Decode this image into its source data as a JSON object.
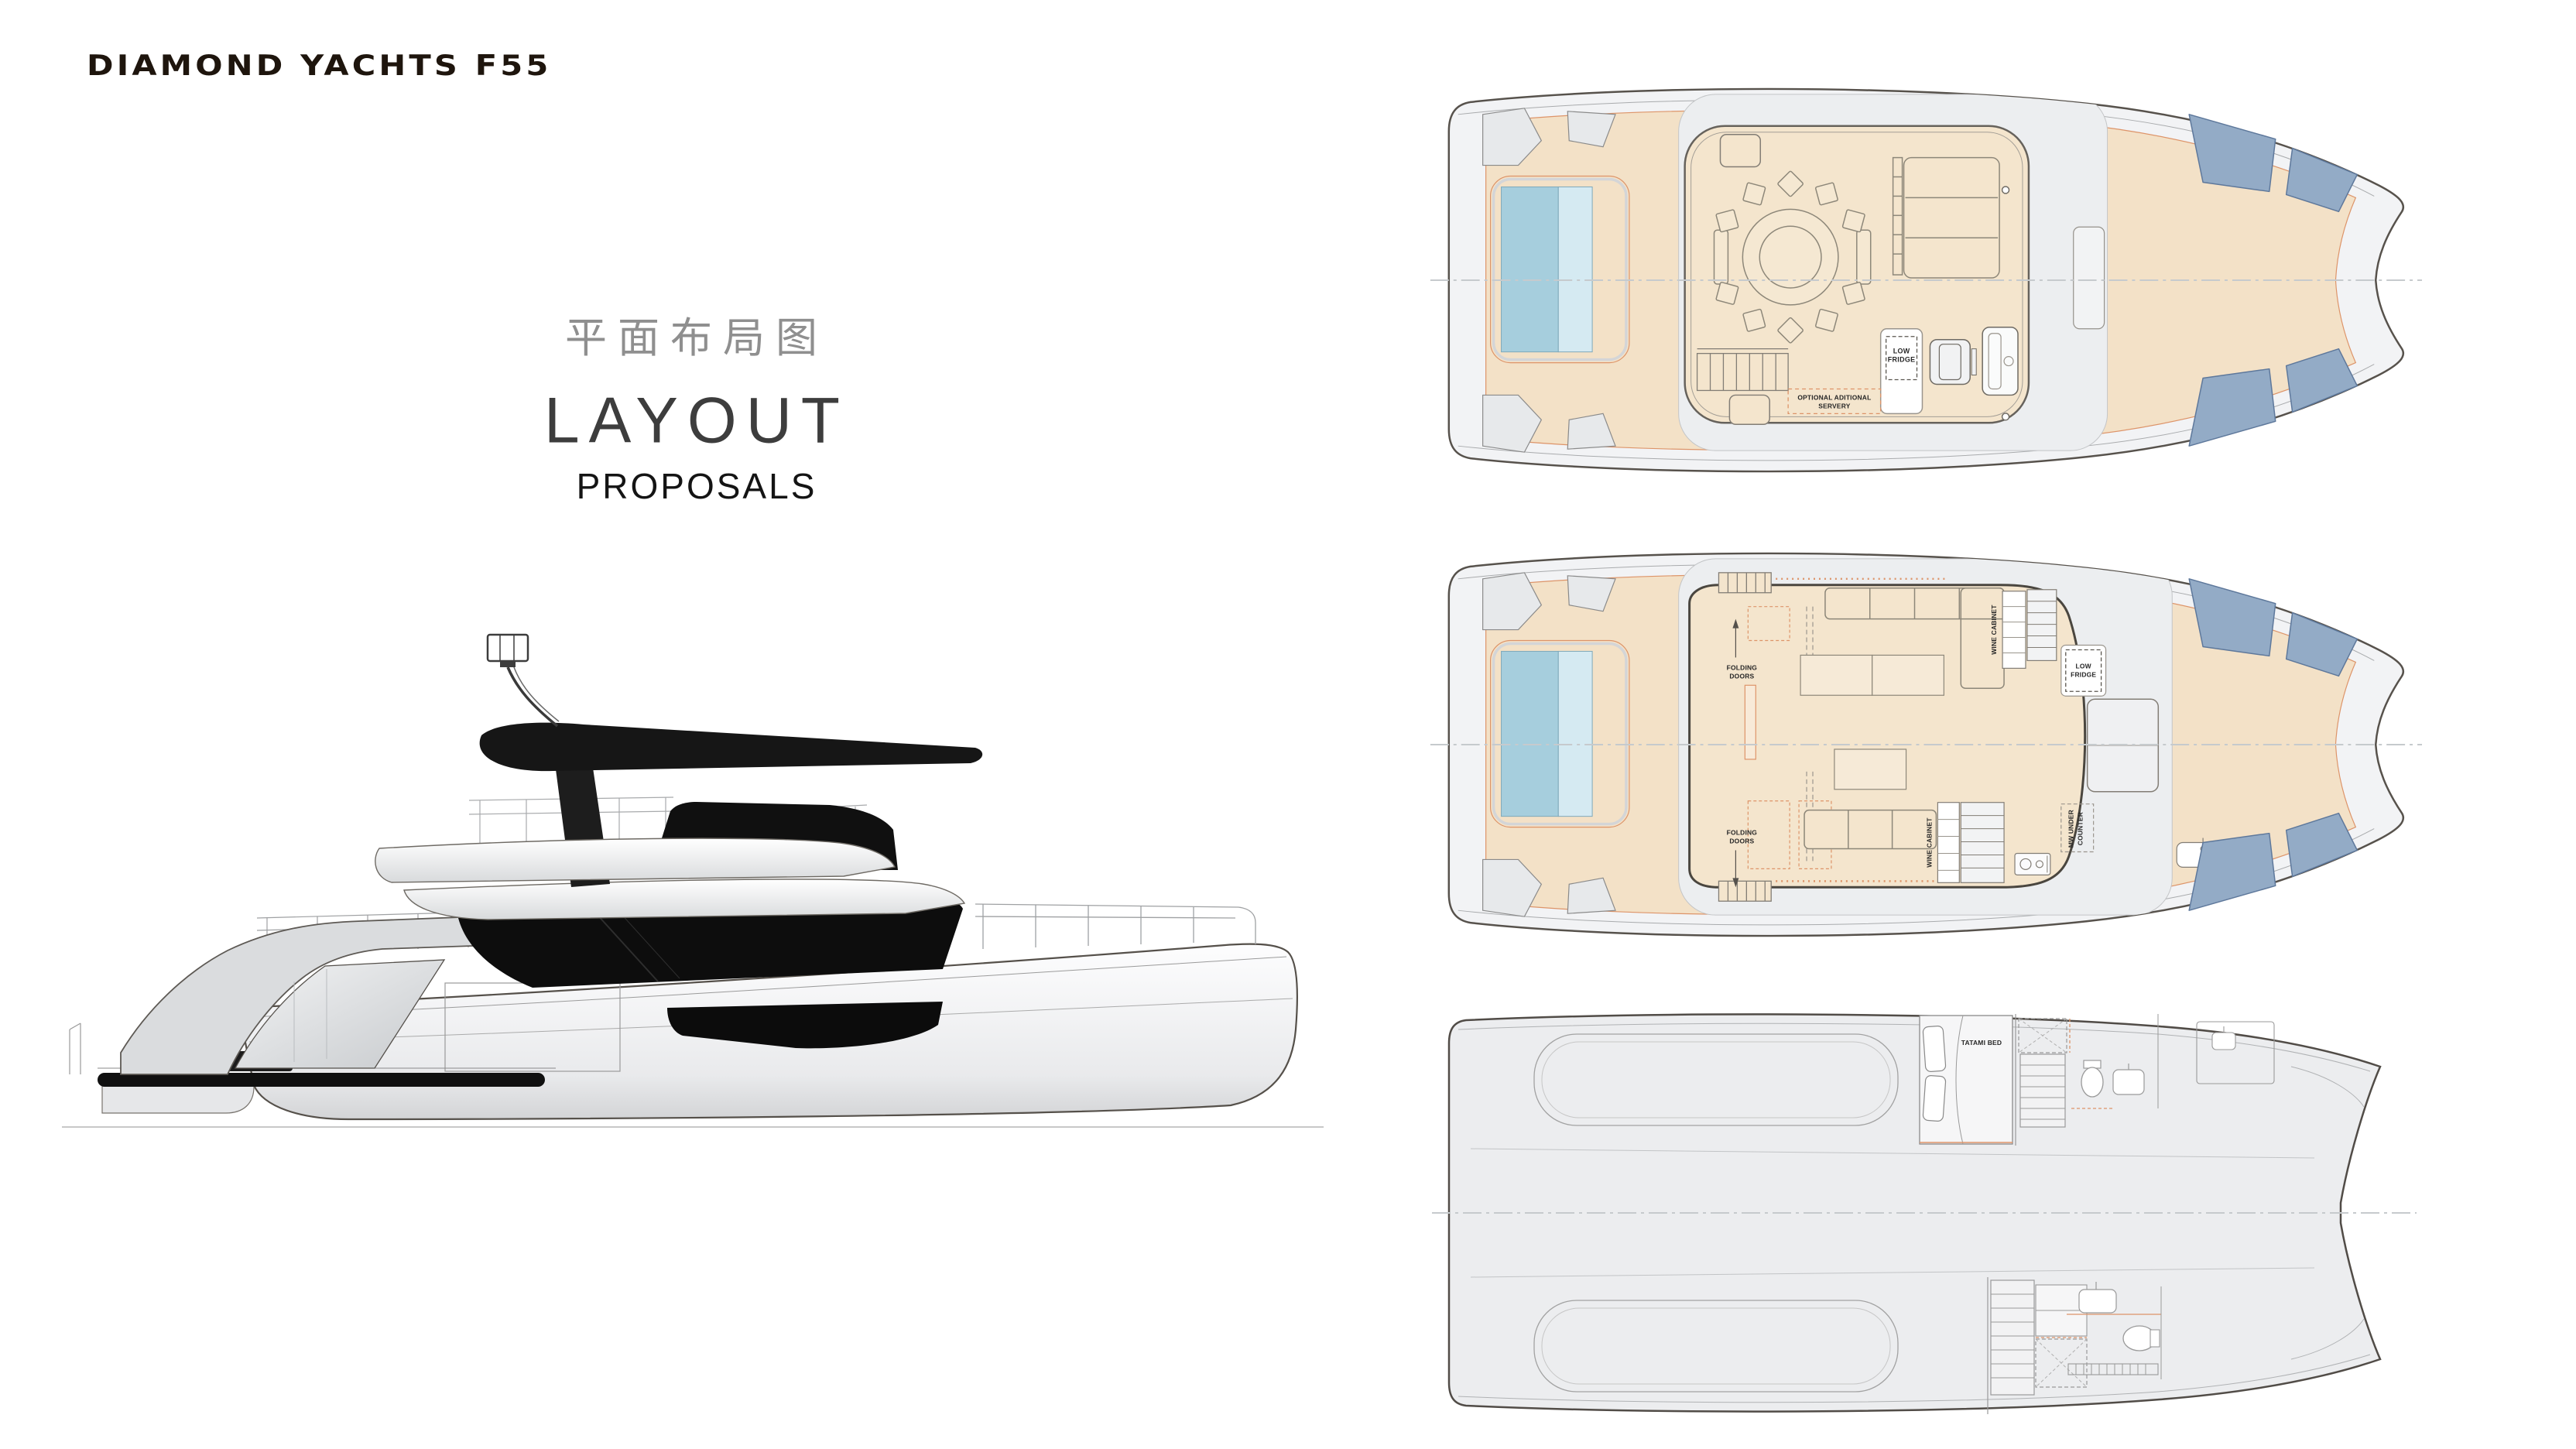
{
  "header": {
    "logo": "DIAMOND YACHTS F55"
  },
  "title": {
    "chinese": "平面布局图",
    "english": "LAYOUT",
    "subtitle": "PROPOSALS"
  },
  "colors": {
    "deck_beige": "#f3e1c7",
    "enclosure_beige": "#f4e5cd",
    "sunpad_blue": "#93abc6",
    "pool_blue_dark": "#a6cedd",
    "pool_blue_light": "#d5eaf2",
    "hull_gray": "#f2f3f5",
    "lower_deck_gray": "#ecedef",
    "accent_orange": "#dd9469",
    "glass_black": "#101010"
  },
  "decks": {
    "flybridge": {
      "labels": {
        "low_fridge": [
          "LOW",
          "FRIDGE"
        ],
        "servery": [
          "OPTIONAL ADITIONAL",
          "SERVERY"
        ]
      }
    },
    "main": {
      "labels": {
        "folding_doors": [
          "FOLDING",
          "DOORS"
        ],
        "wine_cabinet": "WINE CABINET",
        "low_fridge": [
          "LOW",
          "FRIDGE"
        ],
        "mw_under_counter": [
          "MW UNDER",
          "COUNTER"
        ]
      }
    },
    "lower": {
      "labels": {
        "tatami_bed": "TATAMI BED"
      }
    }
  }
}
